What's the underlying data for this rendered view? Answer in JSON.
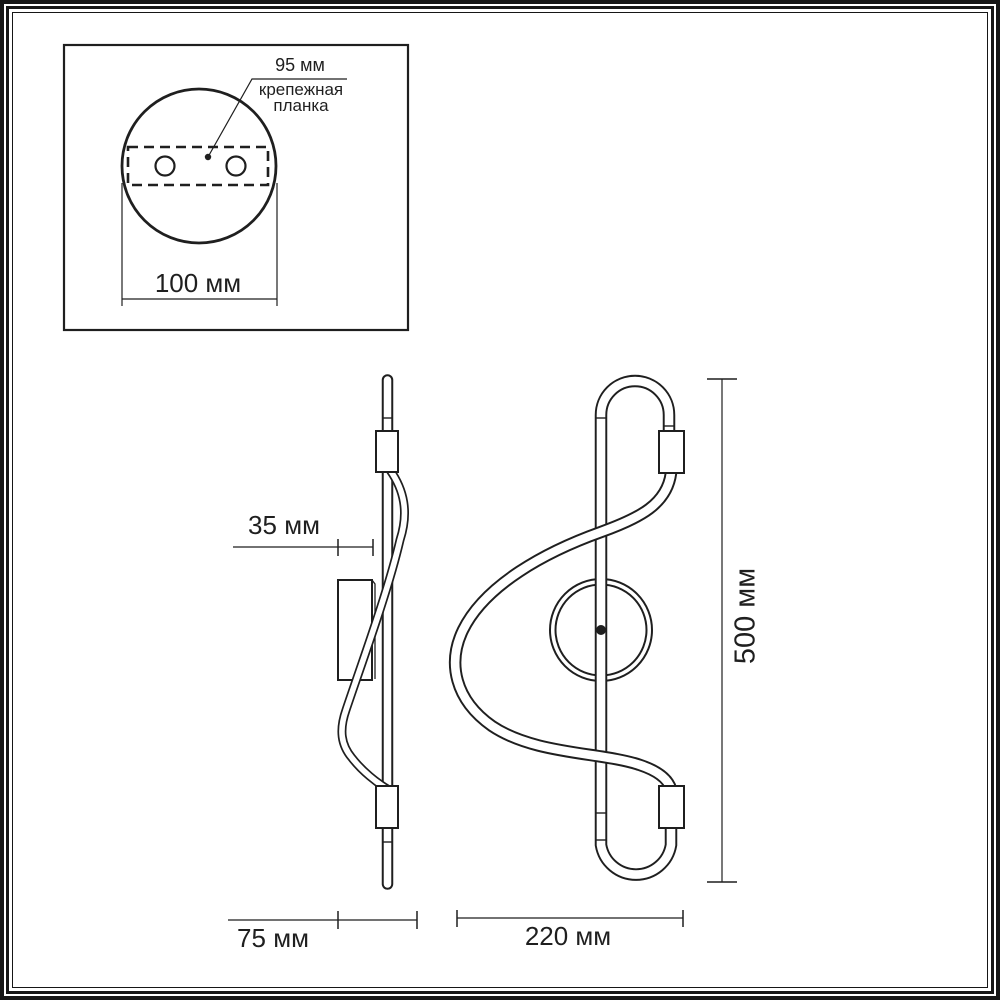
{
  "drawing": {
    "line_color": "#1f1f1f",
    "background_color": "#ffffff"
  },
  "inset": {
    "hole_spacing_label": "95 мм",
    "mount_plate_label_line1": "крепежная",
    "mount_plate_label_line2": "планка",
    "base_diameter_label": "100 мм"
  },
  "side_view": {
    "plate_offset_label": "35 мм",
    "depth_label": "75 мм"
  },
  "front_view": {
    "width_label": "220 мм",
    "height_label": "500 мм"
  }
}
